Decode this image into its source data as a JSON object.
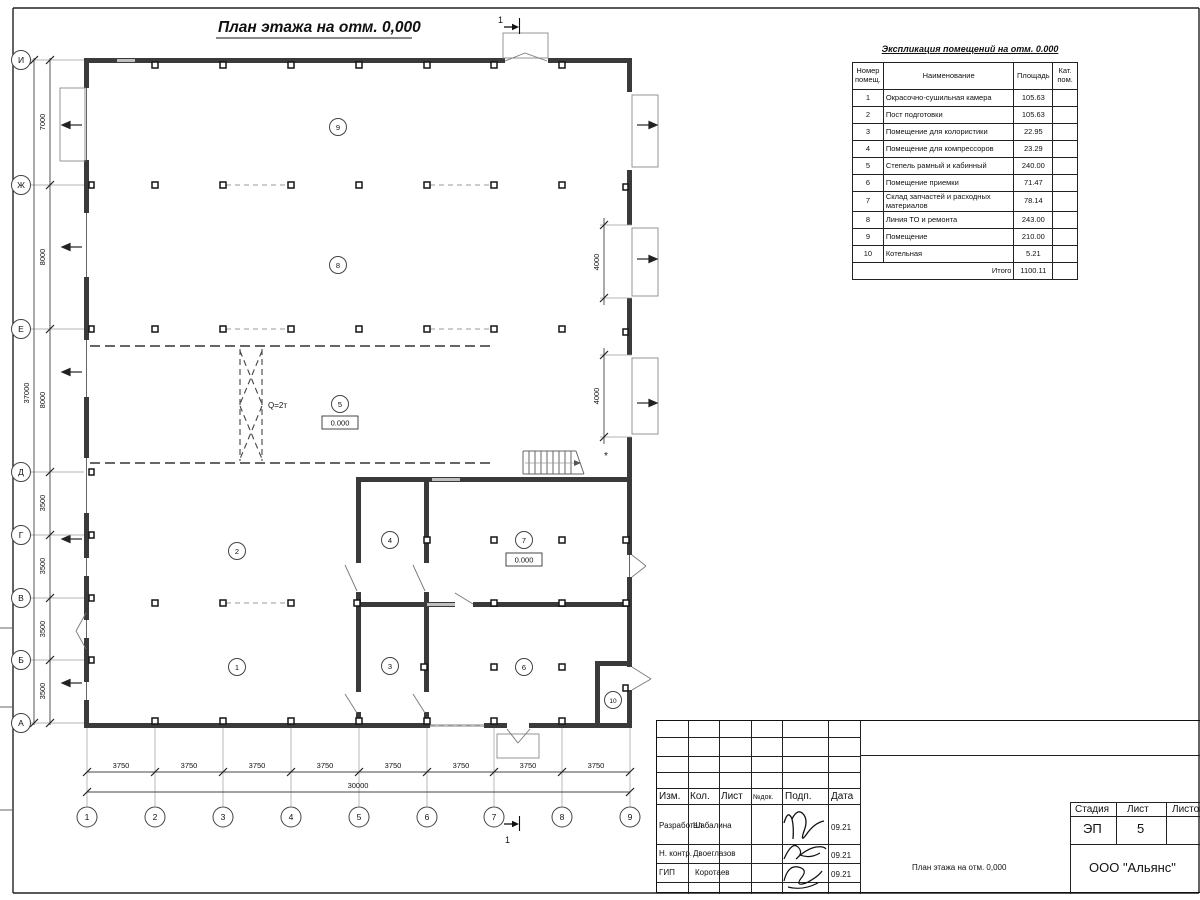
{
  "sheet": {
    "title": "План этажа на отм. 0,000",
    "section_mark": "1",
    "asterisk": "*"
  },
  "plan": {
    "crane_label": "Q=2т",
    "elevation_mark": "0.000",
    "room_numbers": [
      "1",
      "2",
      "3",
      "4",
      "5",
      "6",
      "7",
      "8",
      "9",
      "10"
    ]
  },
  "axes": {
    "rows": [
      "И",
      "Ж",
      "Е",
      "Д",
      "Г",
      "В",
      "Б",
      "А"
    ],
    "row_dims": [
      "7000",
      "8000",
      "8000",
      "3500",
      "3500",
      "3500",
      "3500"
    ],
    "row_total": "37000",
    "cols": [
      "1",
      "2",
      "3",
      "4",
      "5",
      "6",
      "7",
      "8",
      "9"
    ],
    "col_dims": [
      "3750",
      "3750",
      "3750",
      "3750",
      "3750",
      "3750",
      "3750",
      "3750"
    ],
    "col_total": "30000",
    "gate_dims": [
      "4000",
      "4000"
    ]
  },
  "explication": {
    "title": "Экспликация помещений на отм. 0.000",
    "headers": [
      "Номер помещ.",
      "Наименование",
      "Площадь",
      "Кат. пом."
    ],
    "rows": [
      [
        "1",
        "Окрасочно-сушильная камера",
        "105.63",
        ""
      ],
      [
        "2",
        "Пост подготовки",
        "105.63",
        ""
      ],
      [
        "3",
        "Помещение для колористики",
        "22.95",
        ""
      ],
      [
        "4",
        "Помещение для компрессоров",
        "23.29",
        ""
      ],
      [
        "5",
        "Степель рамный и кабинный",
        "240.00",
        ""
      ],
      [
        "6",
        "Помещение приемки",
        "71.47",
        ""
      ],
      [
        "7",
        "Склад запчастей и расходных материалов",
        "78.14",
        ""
      ],
      [
        "8",
        "Линия ТО и ремонта",
        "243.00",
        ""
      ],
      [
        "9",
        "Помещение",
        "210.00",
        ""
      ],
      [
        "10",
        "Котельная",
        "5.21",
        ""
      ]
    ],
    "total_label": "Итого",
    "total": "1100.11"
  },
  "titleblock": {
    "header_cols": [
      "Изм.",
      "Кол.",
      "Лист",
      "№док.",
      "Подп.",
      "Дата"
    ],
    "rows": [
      {
        "role": "Разработал",
        "name": "Шабалина",
        "date": "09.21"
      },
      {
        "role": "Н. контр.",
        "name": "Двоеглазов",
        "date": "09.21"
      },
      {
        "role": "ГИП",
        "name": "Коротаев",
        "date": "09.21"
      }
    ],
    "stage_label": "Стадия",
    "sheet_label": "Лист",
    "sheets_label": "Листов",
    "stage": "ЭП",
    "sheet_num": "5",
    "doc_title": "План этажа на отм. 0,000",
    "company": "ООО \"Альянс\""
  }
}
